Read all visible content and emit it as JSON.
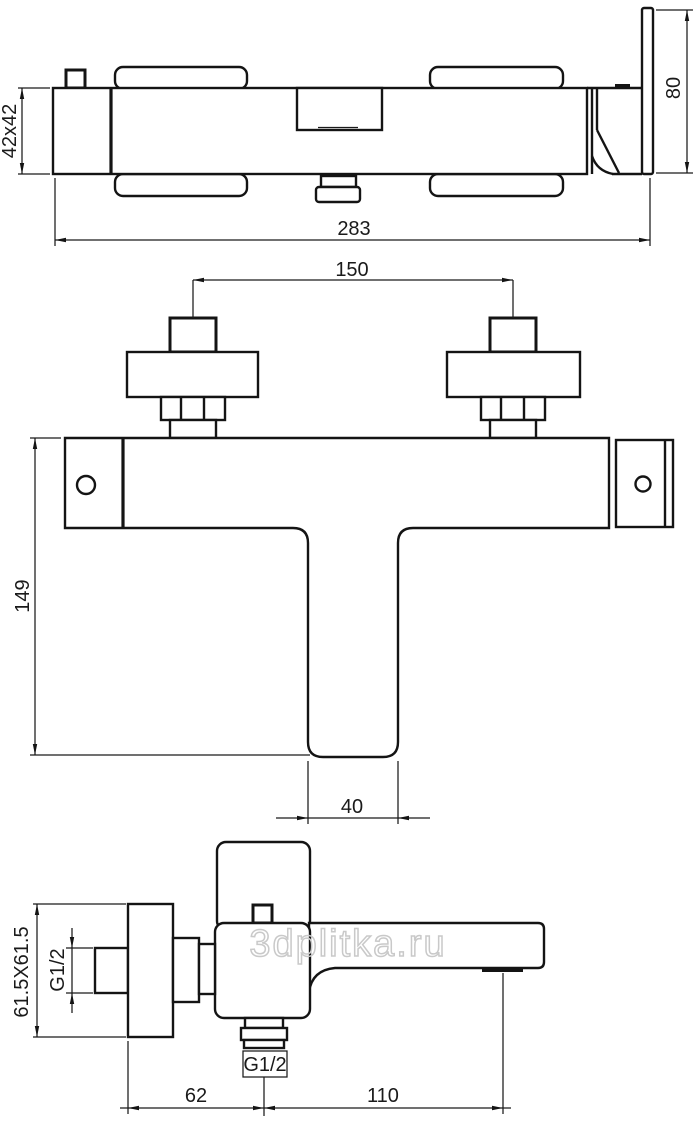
{
  "watermark": "3dplitka.ru",
  "top_view": {
    "dim_body_section": "42x42",
    "dim_overall_length": "283",
    "dim_handle_plate": "80"
  },
  "front_view": {
    "dim_connection_centers": "150",
    "dim_overall_height": "149",
    "dim_spout_width": "40"
  },
  "side_view": {
    "dim_escutcheon_plate": "61.5X61.5",
    "dim_inlet_thread": "G1/2",
    "dim_outlet_thread": "G1/2",
    "dim_wall_to_outlet": "62",
    "dim_outlet_to_handle_end": "110"
  }
}
